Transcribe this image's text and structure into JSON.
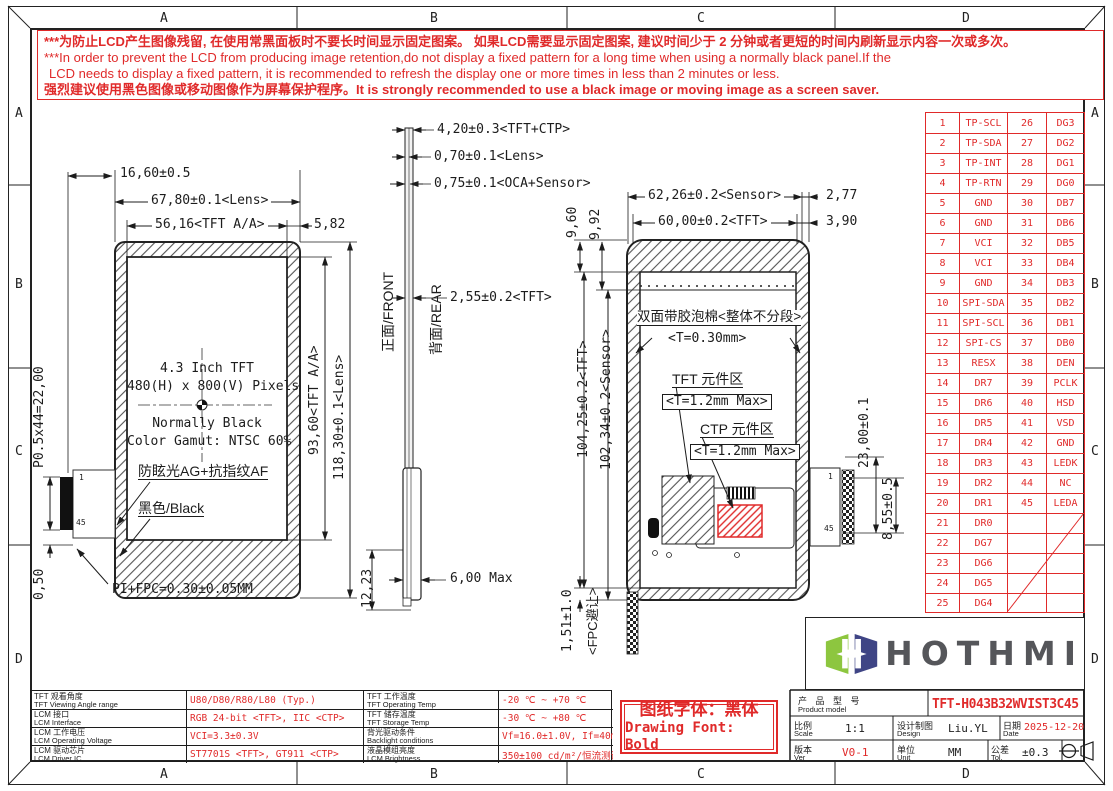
{
  "page": {
    "grid_letters": [
      "A",
      "B",
      "C",
      "D"
    ]
  },
  "colors": {
    "red": "#e02a2a",
    "line": "#1c1c1c",
    "logo_green": "#8dc63f",
    "logo_navy": "#3f4585",
    "logo_text": "#55565a"
  },
  "warning": {
    "line1": "***为防止LCD产生图像残留, 在使用常黑面板时不要长时间显示固定图案。 如果LCD需要显示固定图案, 建议时间少于 2 分钟或者更短的时间内刷新显示内容一次或多次。",
    "line2": "***In order to prevent the LCD from producing image retention,do not display a fixed pattern for a long time when using a normally black panel.If the",
    "line3": "LCD needs to display a fixed pattern,  it is recommended to refresh the display one or more times in less than 2 minutes or less.",
    "line4": "强烈建议使用黑色图像或移动图像作为屏幕保护程序。It is strongly recommended to use a black image or moving image as a screen saver."
  },
  "front_view": {
    "dim_fpc_offset": "16,60±0.5",
    "dim_lens_w": "67,80±0.1<Lens>",
    "dim_aa_w": "56,16<TFT A/A>",
    "dim_right_margin": "5,82",
    "dim_aa_h": "93,60<TFT A/A>",
    "dim_lens_h": "118,30±0.1<Lens>",
    "dim_pin_pitch": "P0.5x44=22,00",
    "dim_bottom_gap": "0,50",
    "pin_first": "1",
    "pin_last": "45",
    "center_line1": "4.3 Inch TFT",
    "center_line2": "480(H) x 800(V) Pixels",
    "center_line3": "Normally Black",
    "center_line4": "Color Gamut: NTSC 60%",
    "label_ag_af": "防眩光AG+抗指纹AF",
    "label_black": "黑色/Black",
    "label_fpc": "PI+FPC=0.30±0.05MM"
  },
  "side_view": {
    "dim_total": "4,20±0.3<TFT+CTP>",
    "dim_lens": "0,70±0.1<Lens>",
    "dim_oca": "0,75±0.1<OCA+Sensor>",
    "dim_tft": "2,55±0.2<TFT>",
    "label_front": "正面/FRONT",
    "label_rear": "背面/REAR",
    "dim_bottom": "12,23",
    "dim_thickness": "6,00 Max"
  },
  "rear_view": {
    "dim_sensor_w": "62,26±0.2<Sensor>",
    "dim_right_off1": "2,77",
    "dim_tft_w": "60,00±0.2<TFT>",
    "dim_right_off2": "3,90",
    "dim_top1": "9,60",
    "dim_top2": "9,92",
    "dim_tft_h": "104,25±0.2<TFT>",
    "dim_sensor_h": "102,34±0.2<Sensor>",
    "dim_fpc_gap": "1,51±1.0",
    "label_fpc_gap": "<FPC避让>",
    "label_foam": "双面带胶泡棉<整体不分段>",
    "label_foam_t": "<T=0.30mm>",
    "label_tft_area": "TFT 元件区",
    "label_tft_area_t": "<T=1.2mm Max>",
    "label_ctp_area": "CTP 元件区",
    "label_ctp_area_t": "<T=1.2mm Max>",
    "dim_conn1": "23,00±0.1",
    "dim_conn2": "8,55±0.5",
    "pin_first": "1",
    "pin_last": "45"
  },
  "pin_table": {
    "rows": [
      [
        "1",
        "TP-SCL",
        "26",
        "DG3"
      ],
      [
        "2",
        "TP-SDA",
        "27",
        "DG2"
      ],
      [
        "3",
        "TP-INT",
        "28",
        "DG1"
      ],
      [
        "4",
        "TP-RTN",
        "29",
        "DG0"
      ],
      [
        "5",
        "GND",
        "30",
        "DB7"
      ],
      [
        "6",
        "GND",
        "31",
        "DB6"
      ],
      [
        "7",
        "VCI",
        "32",
        "DB5"
      ],
      [
        "8",
        "VCI",
        "33",
        "DB4"
      ],
      [
        "9",
        "GND",
        "34",
        "DB3"
      ],
      [
        "10",
        "SPI-SDA",
        "35",
        "DB2"
      ],
      [
        "11",
        "SPI-SCL",
        "36",
        "DB1"
      ],
      [
        "12",
        "SPI-CS",
        "37",
        "DB0"
      ],
      [
        "13",
        "RESX",
        "38",
        "DEN"
      ],
      [
        "14",
        "DR7",
        "39",
        "PCLK"
      ],
      [
        "15",
        "DR6",
        "40",
        "HSD"
      ],
      [
        "16",
        "DR5",
        "41",
        "VSD"
      ],
      [
        "17",
        "DR4",
        "42",
        "GND"
      ],
      [
        "18",
        "DR3",
        "43",
        "LEDK"
      ],
      [
        "19",
        "DR2",
        "44",
        "NC"
      ],
      [
        "20",
        "DR1",
        "45",
        "LEDA"
      ],
      [
        "21",
        "DR0",
        "",
        ""
      ],
      [
        "22",
        "DG7",
        "",
        ""
      ],
      [
        "23",
        "DG6",
        "",
        ""
      ],
      [
        "24",
        "DG5",
        "",
        ""
      ],
      [
        "25",
        "DG4",
        "",
        ""
      ]
    ]
  },
  "logo": {
    "text": "HOTHMI"
  },
  "spec_table": {
    "rows": [
      {
        "c1cn": "TFT 观看角度",
        "c1en": "TFT Viewing Angle range",
        "v1": "U80/D80/R80/L80 (Typ.)",
        "c2cn": "TFT 工作温度",
        "c2en": "TFT Operating Temp",
        "v2": "-20 ℃ ~ +70 ℃"
      },
      {
        "c1cn": "LCM 接口",
        "c1en": "LCM Interface",
        "v1": "RGB 24-bit <TFT>, IIC <CTP>",
        "c2cn": "TFT 储存温度",
        "c2en": "TFT Storage Temp",
        "v2": "-30 ℃ ~ +80 ℃"
      },
      {
        "c1cn": "LCM 工作电压",
        "c1en": "LCM Operating Voltage",
        "v1": "VCI=3.3±0.3V",
        "c2cn": "背光驱动条件",
        "c2en": "Backlight conditions",
        "v2": "Vf=16.0±1.0V, If=40mA"
      },
      {
        "c1cn": "LCM 驱动芯片",
        "c1en": "LCM Driver IC",
        "v1": "ST7701S <TFT>, GT911 <CTP>",
        "c2cn": "液晶模组亮度",
        "c2en": "LCM Brightness",
        "v2": "350±100 cd/m²/恒流测试"
      }
    ]
  },
  "font_note": {
    "line1": "图纸字体：黑体",
    "line2": "Drawing Font: Bold"
  },
  "title_block": {
    "product_label_cn": "产 品 型 号",
    "product_label_en": "Product model",
    "product_model": "TFT-H043B32WVIST3C45",
    "scale_cn": "比例",
    "scale_en": "Scale",
    "scale_val": "1:1",
    "design_cn": "设计制图",
    "design_en": "Design",
    "design_val": "Liu.YL",
    "date_cn": "日期",
    "date_en": "Date",
    "date_val": "2025-12-20",
    "ver_cn": "版本",
    "ver_en": "Ver",
    "ver_val": "V0-1",
    "unit_cn": "单位",
    "unit_en": "Unit",
    "unit_val": "MM",
    "tol_cn": "公差",
    "tol_en": "Tol.",
    "tol_val": "±0.3"
  }
}
